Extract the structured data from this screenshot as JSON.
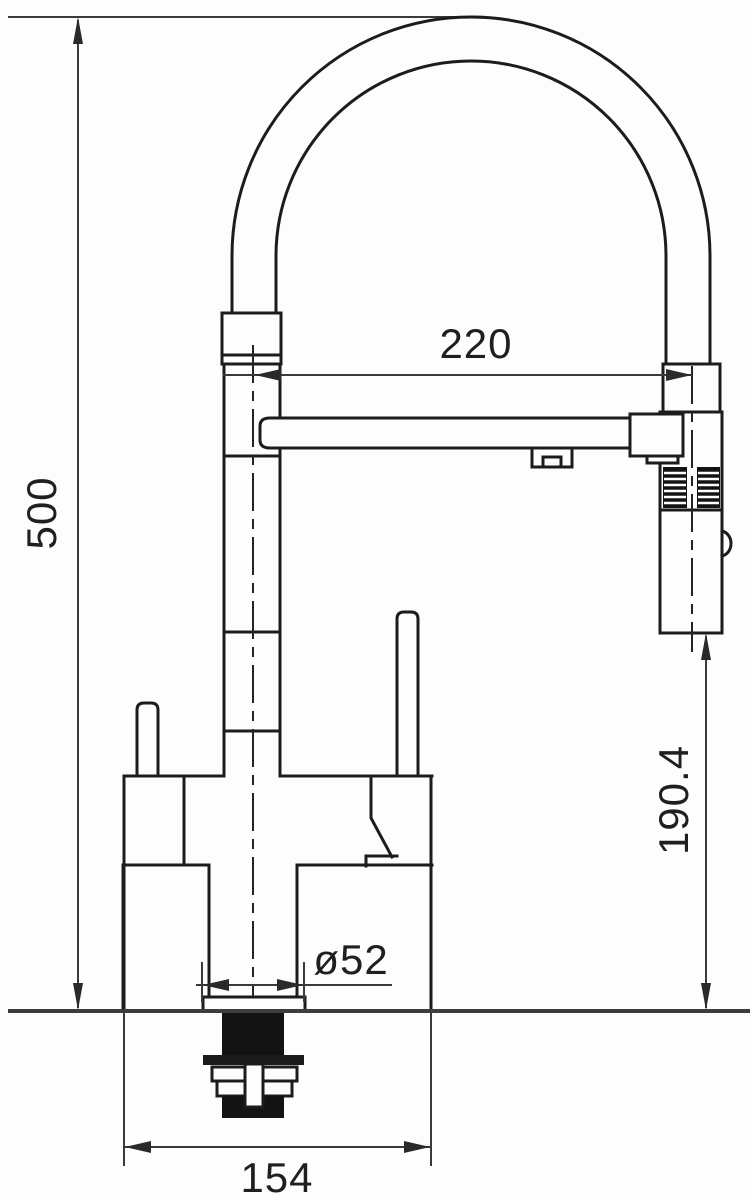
{
  "drawing": {
    "title": "Kitchen faucet technical dimension drawing",
    "units": "mm",
    "dimensions": {
      "overall_height": "500",
      "spout_reach": "220",
      "spout_clearance": "190.4",
      "base_diameter": "ø52",
      "body_width": "154"
    }
  }
}
